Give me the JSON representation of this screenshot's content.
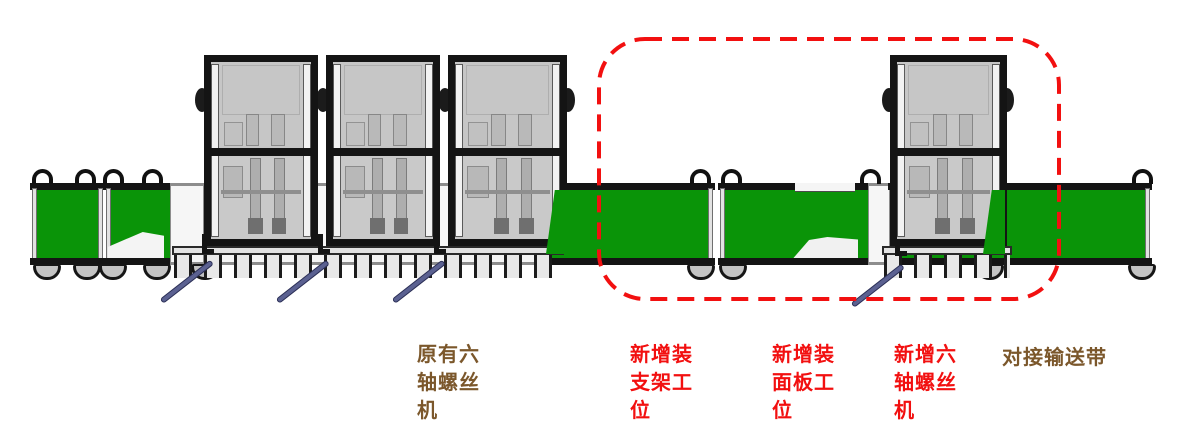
{
  "diagram": {
    "type": "production-line-equipment-layout",
    "labels": {
      "existing_six_axis_screw_machine": {
        "lines": [
          "原有六",
          "轴螺丝",
          "机"
        ],
        "color_key": "label_brown"
      },
      "new_bracket_station": {
        "lines": [
          "新增装",
          "支架工",
          "位"
        ],
        "color_key": "highlight_red"
      },
      "new_panel_station": {
        "lines": [
          "新增装",
          "面板工",
          "位"
        ],
        "color_key": "highlight_red"
      },
      "new_six_axis_screw_machine": {
        "lines": [
          "新增六",
          "轴螺丝",
          "机"
        ],
        "color_key": "highlight_red"
      },
      "docking_conveyor": {
        "lines": [
          "对接输送带"
        ],
        "color_key": "label_brown"
      }
    },
    "highlight_box": {
      "shape": "dashed-rounded-rect",
      "color_key": "highlight_red"
    },
    "colors": {
      "conveyor_green": "#0a9408",
      "highlight_red": "#f21010",
      "label_brown": "#7b572b",
      "machine_gray": "#c6c6c6",
      "frame_black": "#141414",
      "rod_blue": "#5b6191"
    }
  }
}
